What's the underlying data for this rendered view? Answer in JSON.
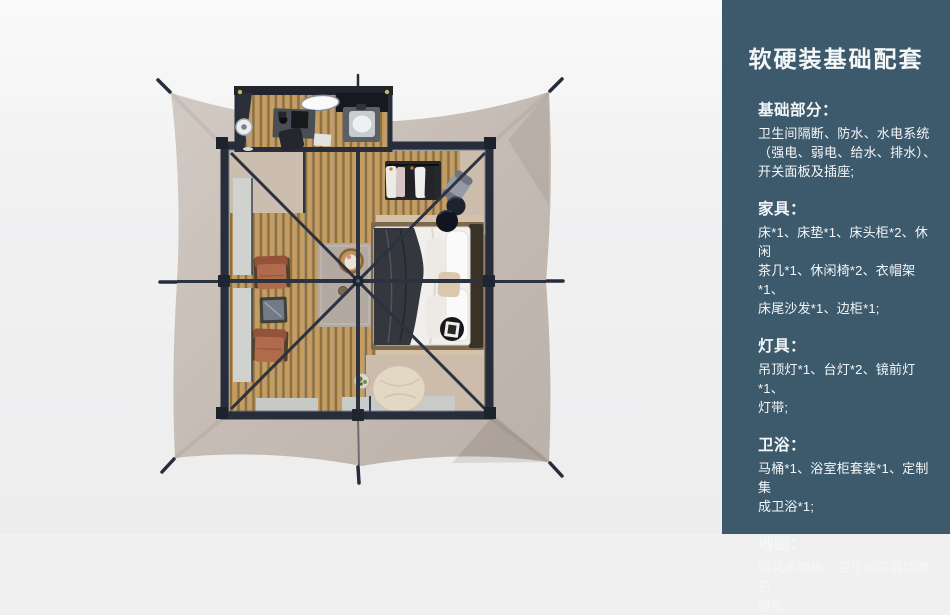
{
  "palette": {
    "page_bg": "#f0f0f1",
    "panel": "#3d5a6c",
    "panel_text": "#f4f7f8",
    "canopy": "#c6bcb4",
    "frame_dark": "#2c3240",
    "wood_floor": "#c49d62",
    "bed_linen": "#f2f0ec",
    "throw_blanket": "#34373d",
    "chair_terracotta": "#b06b4c",
    "pouf_cream": "#e3d9c4"
  },
  "sidebar": {
    "title": "软硬装基础配套",
    "sections": [
      {
        "heading": "基础部分：",
        "body": "卫生间隔断、防水、水电系统\n（强电、弱电、给水、排水）、\n开关面板及插座;"
      },
      {
        "heading": "家具：",
        "body": "床*1、床垫*1、床头柜*2、休闲\n茶几*1、休闲椅*2、衣帽架*1、\n床尾沙发*1、边柜*1;"
      },
      {
        "heading": "灯具：",
        "body": "吊顶灯*1、台灯*2、镜前灯*1、\n灯带;"
      },
      {
        "heading": "卫浴：",
        "body": "马桶*1、浴室柜套装*1、定制集\n成卫浴*1;"
      },
      {
        "heading": "地面：",
        "body": "强化木地板、卫生间防滑防潮石\n塑板;"
      }
    ]
  },
  "scene": {
    "type": "3d-top-view-render",
    "subject": "glamping-tent-bedroom-floorplan",
    "items": [
      "tent-canopy",
      "guy-line-stake",
      "ridge-beam",
      "roof-frame",
      "cross-braces",
      "center-hub",
      "bathroom-box",
      "mirror",
      "sink-unit",
      "vanity-desk",
      "desk-chair",
      "standing-fan",
      "bath-mat",
      "window-panel",
      "floor-mat",
      "clothes-rack",
      "garment-bag",
      "round-stool",
      "bed",
      "pillows",
      "throw-blanket",
      "bed-rug",
      "gray-rug",
      "basket-chair",
      "lounge-chair",
      "glass-side-table",
      "black-side-table",
      "book",
      "beanbag-pouf",
      "plant-table"
    ]
  }
}
